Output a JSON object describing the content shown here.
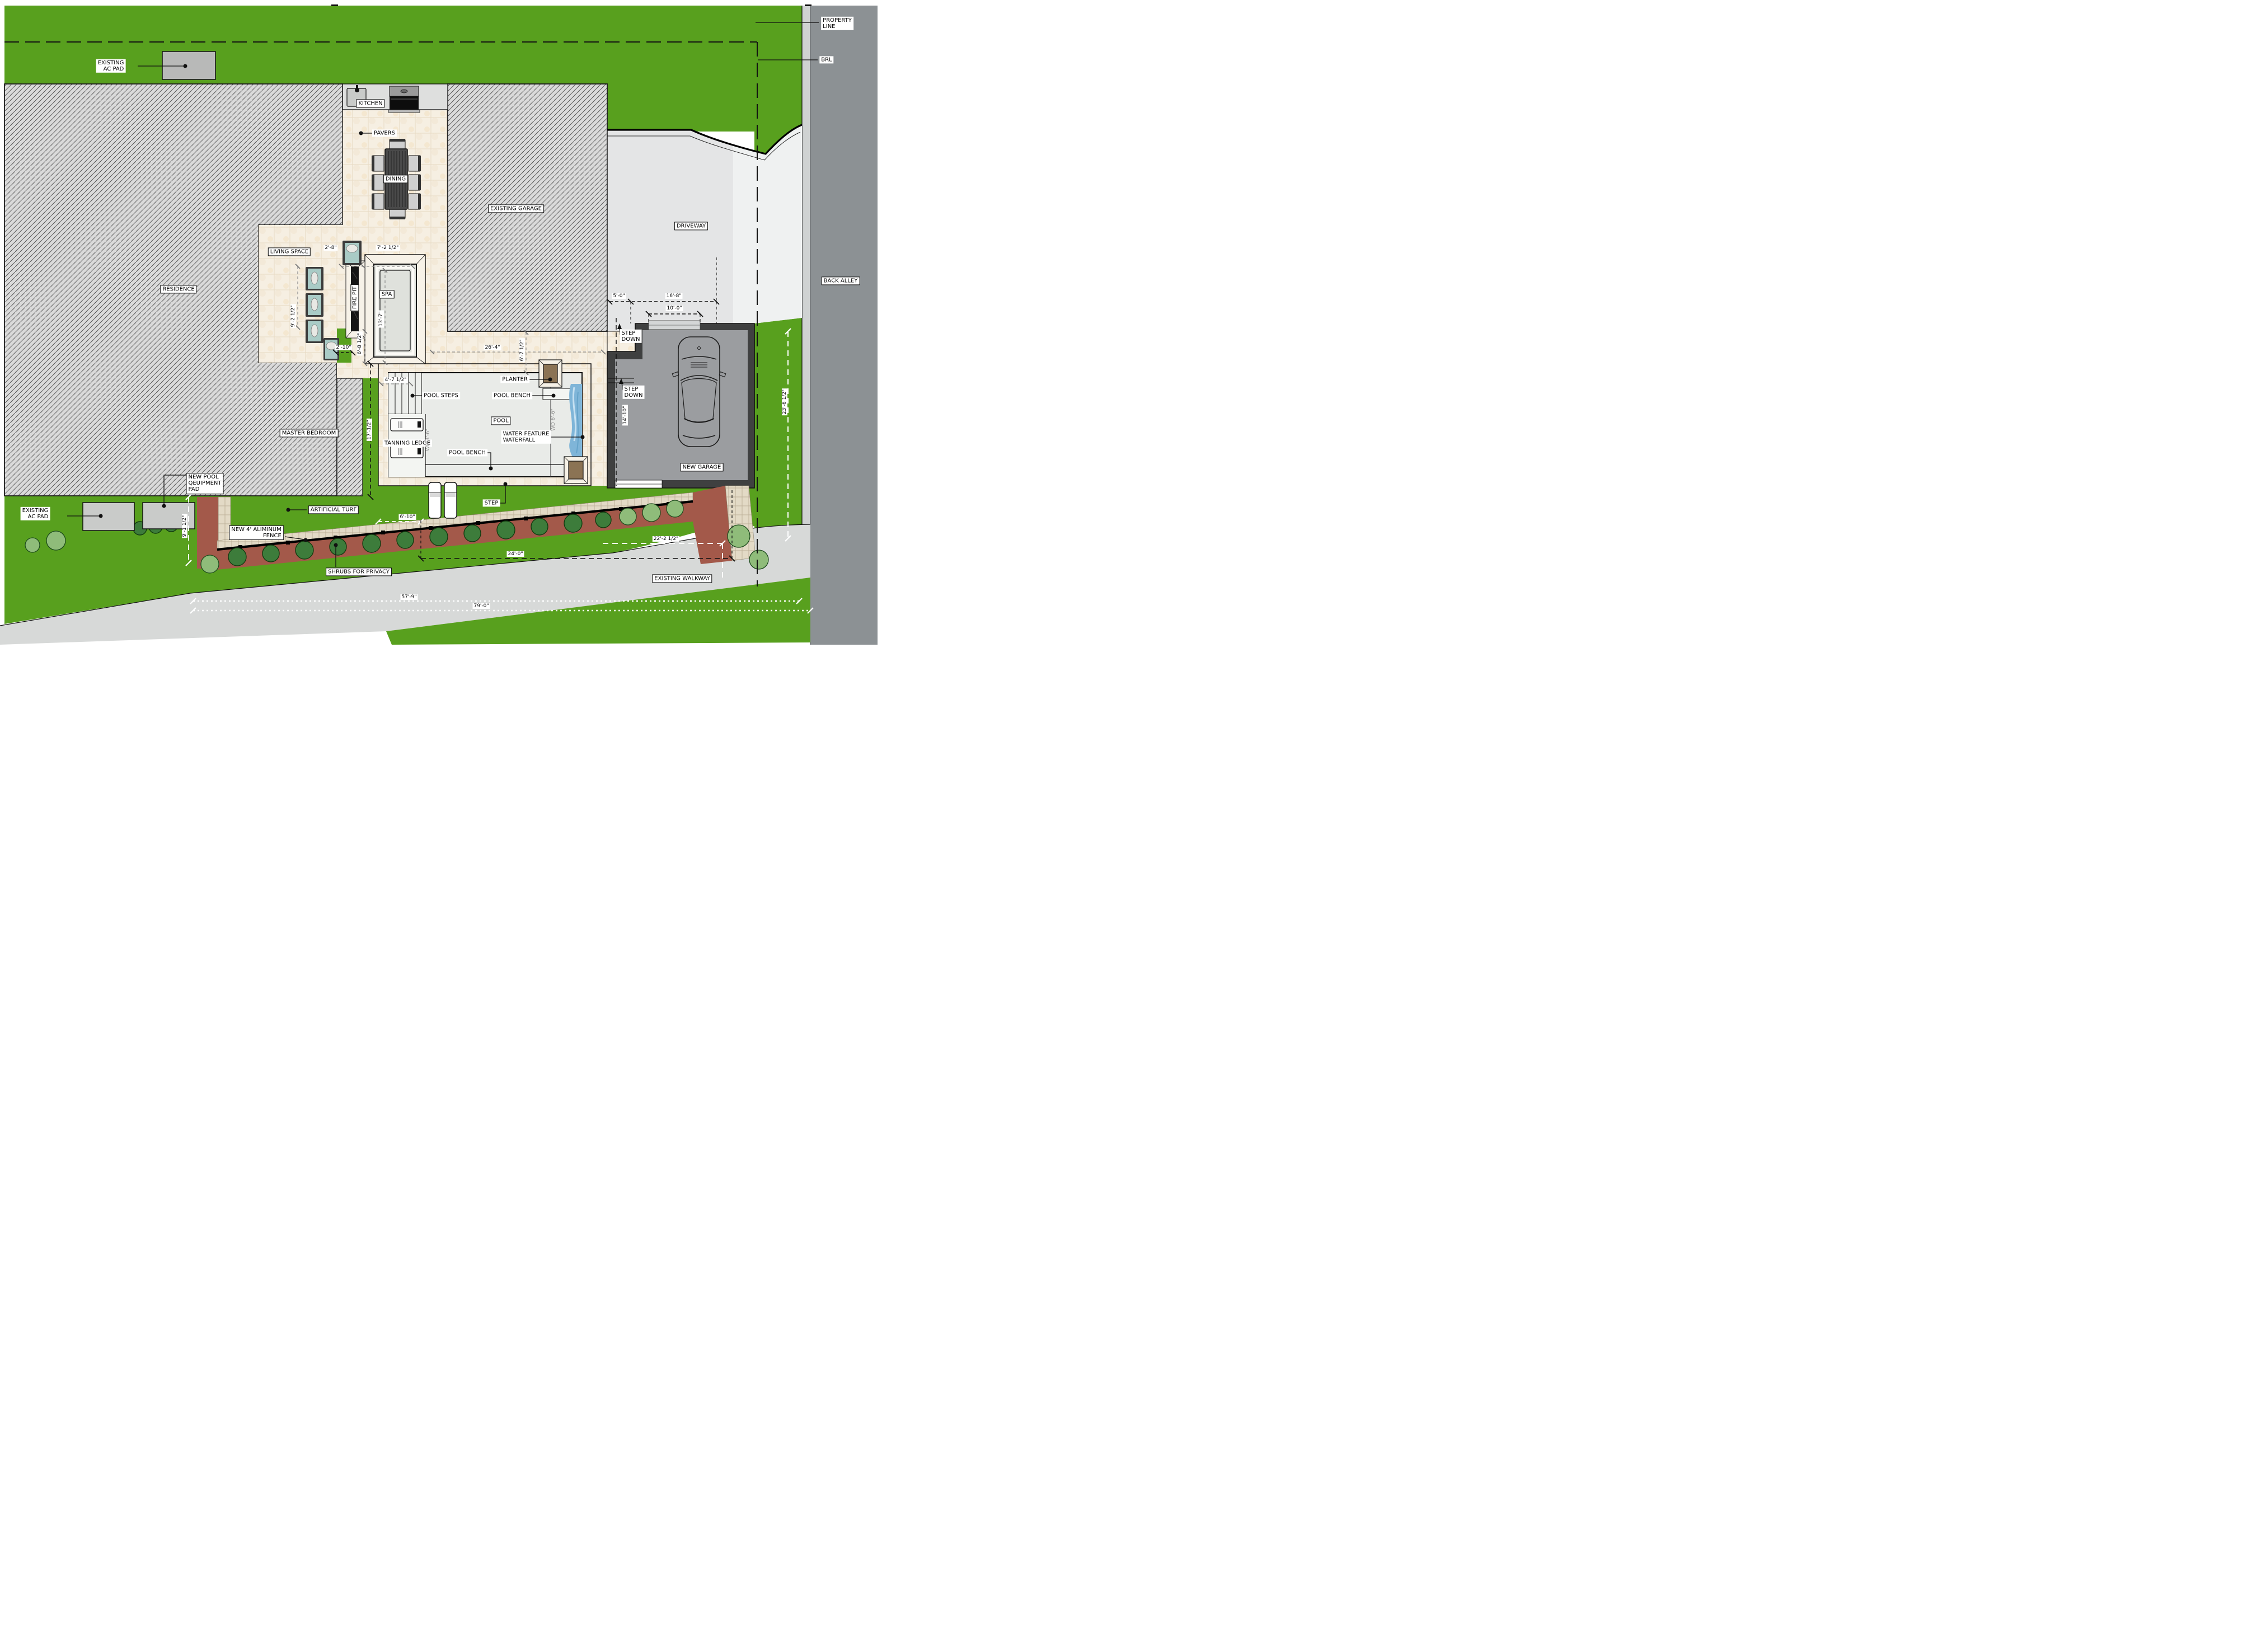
{
  "colors": {
    "grass": "#58a01e",
    "alley": "#8c9194",
    "sidewalk": "#cfd2d2",
    "driveway": "#e4e5e6",
    "apron": "#eff1f1",
    "walkway": "#d7d9d8",
    "pavers": "#f6efe2",
    "hatch_bg": "#dadada",
    "water": "#e9ebe8",
    "ledge": "#f3f5f2",
    "waterfall": "#7fb5d8",
    "garage_wall": "#3f4040",
    "garage_floor": "#9b9da0",
    "mulch": "#a3594a",
    "shrub": "#3d7c3b",
    "bush_light": "#8fbc7a",
    "planter": "#8b7354",
    "pad": "#b8b9b8",
    "teal_cushion": "#a9cbc6"
  },
  "labels": {
    "property_line": {
      "line1": "PROPERTY",
      "line2": "LINE"
    },
    "brl": "BRL",
    "existing_ac_pad": {
      "line1": "EXISTING",
      "line2": "AC PAD"
    },
    "kitchen": "KITCHEN",
    "pavers": "PAVERS",
    "dining": "DINING",
    "existing_garage": "EXISTING GARAGE",
    "driveway": "DRIVEWAY",
    "back_alley": "BACK ALLEY",
    "living_space": "LIVING SPACE",
    "residence": "RESIDENCE",
    "spa": "SPA",
    "fire_pit": "FIRE PIT",
    "master_bedroom": "MASTER BEDROOM",
    "pool": "POOL",
    "pool_steps": "POOL STEPS",
    "planter": "PLANTER",
    "pool_bench": "POOL BENCH",
    "water_feature": {
      "line1": "WATER FEATURE",
      "line2": "WATERFALL"
    },
    "tanning_ledge": "TANNING LEDGE",
    "step_down": {
      "line1": "STEP",
      "line2": "DOWN"
    },
    "new_garage": "NEW GARAGE",
    "artificial_turf": "ARTIFICIAL TURF",
    "new_pool_equipment_pad": {
      "line1": "NEW POOL",
      "line2": "QEUIPMENT",
      "line3": "PAD"
    },
    "aluminum_fence": {
      "line1": "NEW 4' ALIMINUM",
      "line2": "FENCE"
    },
    "shrubs": "SHRUBS FOR PRIVACY",
    "existing_walkway": "EXISTING WALKWAY",
    "step": "STEP"
  },
  "dimensions": {
    "chair_width": "2'-8\"",
    "spa_width": "7'-2 1/2\"",
    "living_depth": "9'-2 1/2\"",
    "spa_terrace": "13'-7\"",
    "turf_width": "2'-10\"",
    "walk_width": "6'-8 1/2\"",
    "deck_width": "26'-4\"",
    "deck_depth": "6'-7 1/2\"",
    "steps_width": "4'-7 1/2\"",
    "turf_length": "17'-1/2\"",
    "depth_shallow": "WD 3'-6\"",
    "depth_deep": "WD 6'-6\"",
    "drive_side": "5'-0\"",
    "drive_width": "16'-8\"",
    "door_width": "10'-0\"",
    "garage_inner": "14'-10\"",
    "rear_setback": "23'-6 1/2\"",
    "equip_depth": "9'-1 1/2\"",
    "turf_gap": "6'-10\"",
    "yard_width": "24'-0\"",
    "side_yard": "22'-2 1/2\"",
    "walkway_len1": "57'-9\"",
    "walkway_len2": "79'-0\""
  }
}
